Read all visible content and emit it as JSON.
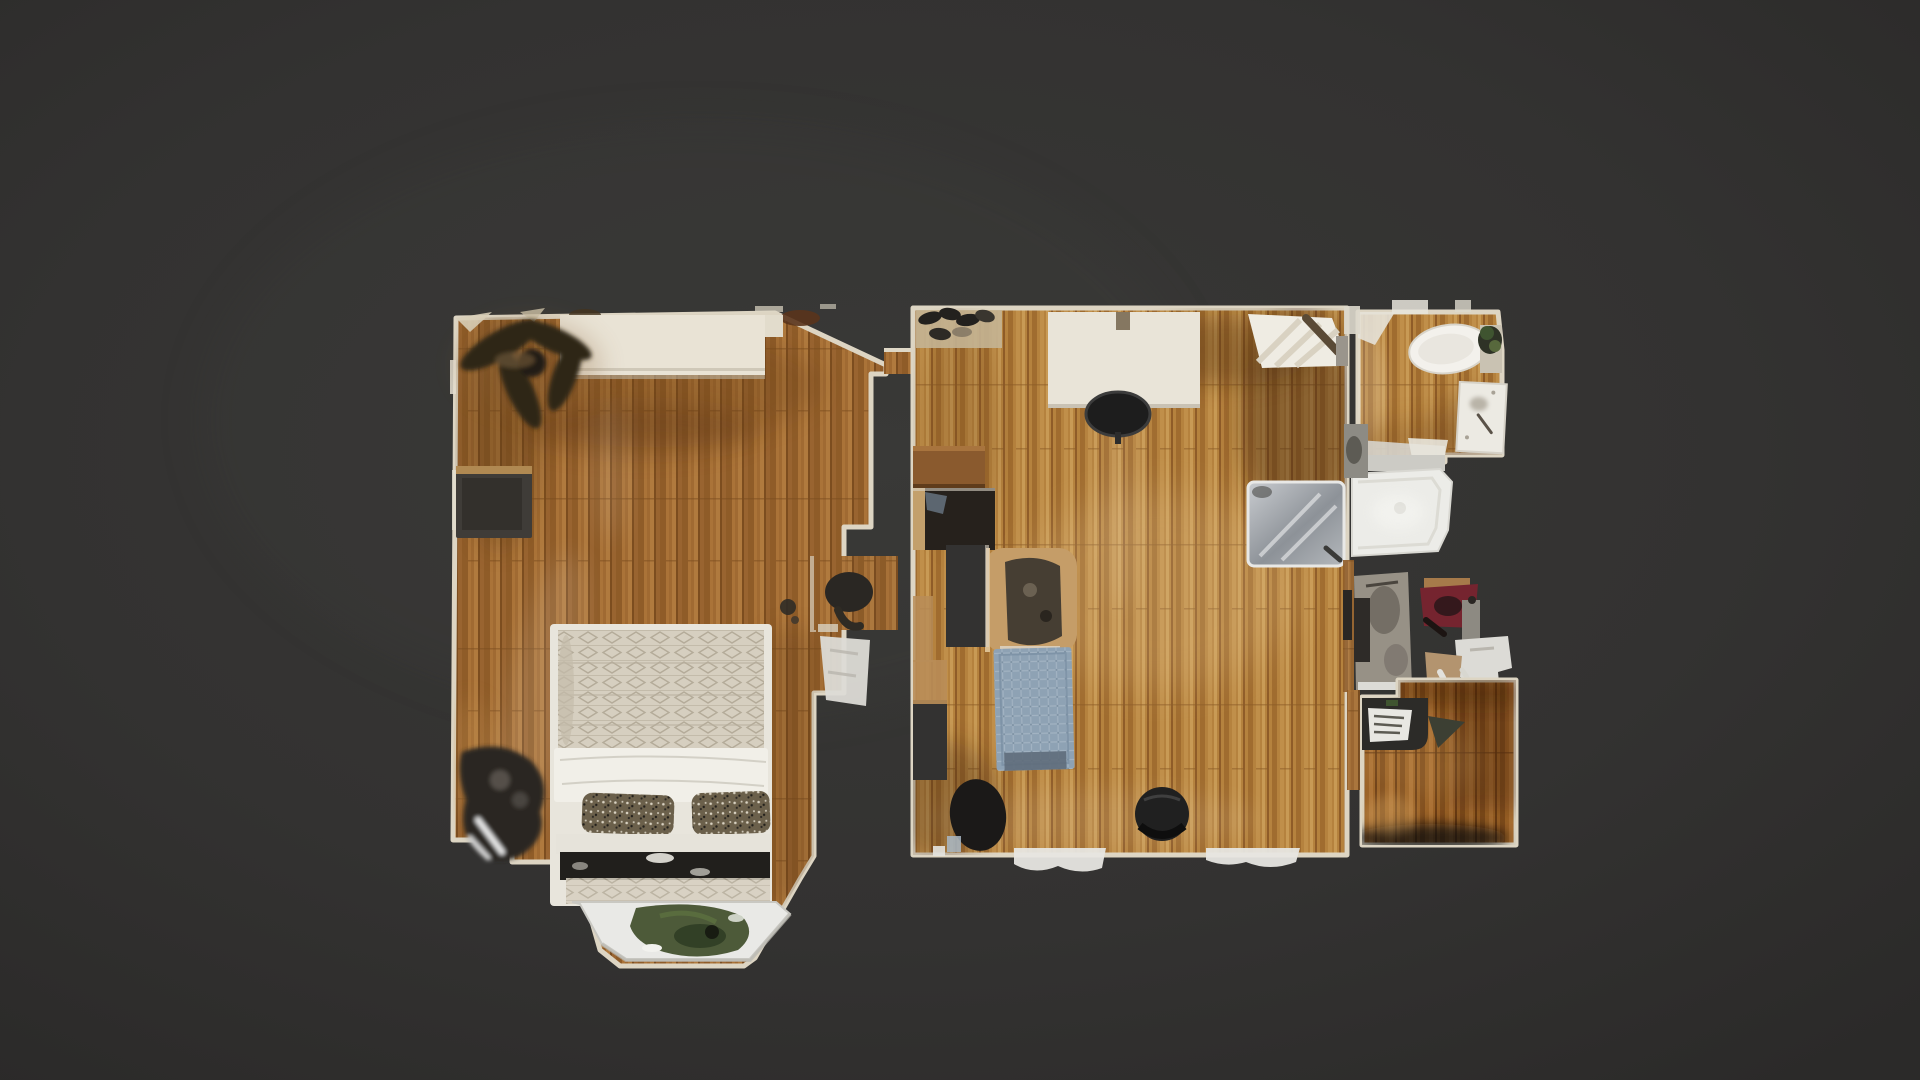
{
  "app": {
    "name": "3d-home-tour-floorplan-view",
    "view_mode": "floorplan-top-down"
  },
  "colors": {
    "background": "#333231",
    "background_edge": "#2c2b2a",
    "trim": "#ddd5c3",
    "wood_base": "#a06a32",
    "wood_dark": "#8f5c28",
    "wood_light": "#b07a3e",
    "wood_living_base": "#b5823e",
    "wood_office_base": "#9a6126",
    "dresser": "#e9e3d5",
    "fan_dark": "#2e2519",
    "wall_unit": "#3f3c38",
    "clothes_dark": "#2b2823",
    "bed_frame": "#e8e5dc",
    "bed_blanket": "#d6cfc0",
    "bed_sheet": "#f1efe8",
    "pillow_speckled": "#6b604b",
    "pillow_black": "#211f1c",
    "window_seat": "#e9e9e6",
    "plant": "#45522f",
    "shoe_mat": "#c4b494",
    "shoe_dark": "#23211e",
    "desk": "#e9e4d8",
    "office_chair": "#1d1d1d",
    "rack_light": "#efece3",
    "side_table": "#8a5a2e",
    "tv_cabinet": "#26211c",
    "glass_light": "#c9ccd0",
    "glass_dark": "#8d9298",
    "armchair": "#c59d68",
    "armchair_seat": "#463e33",
    "rug": "#8ea2b4",
    "rug_weave": "#a2b3c2",
    "rug_band": "#5f6d7b",
    "chair_black": "#202020",
    "radiator": "#e7e6e1",
    "toilet": "#f3f1ec",
    "vanity": "#eceae3",
    "tub": "#ecece8",
    "shower_glass": "#cccbc5",
    "closet_gray": "#979186",
    "fragment_red": "#75242f",
    "fragment_tan": "#b3946f",
    "fragment_white": "#dcdbd6",
    "laptop_desk": "#2c2b28",
    "laptop": "#e8e7e2"
  },
  "rooms": [
    {
      "name": "bedroom",
      "furniture": [
        "dresser",
        "ceiling-fan",
        "wall-unit",
        "clothes-pile",
        "bed",
        "pillows",
        "bay-window-seat",
        "plant"
      ]
    },
    {
      "name": "living-room",
      "furniture": [
        "shoe-mat",
        "desk",
        "office-chair",
        "clothes-rack",
        "side-table",
        "tv-cabinet",
        "glass-panel",
        "armchair",
        "rug",
        "black-chair",
        "radiators"
      ]
    },
    {
      "name": "bathroom",
      "furniture": [
        "toilet",
        "vanity-sink",
        "shower",
        "bathtub"
      ]
    },
    {
      "name": "closet",
      "furniture": [
        "wardrobe-fragments",
        "red-storage-fragment"
      ]
    },
    {
      "name": "office-nook",
      "furniture": [
        "laptop-desk"
      ]
    }
  ]
}
